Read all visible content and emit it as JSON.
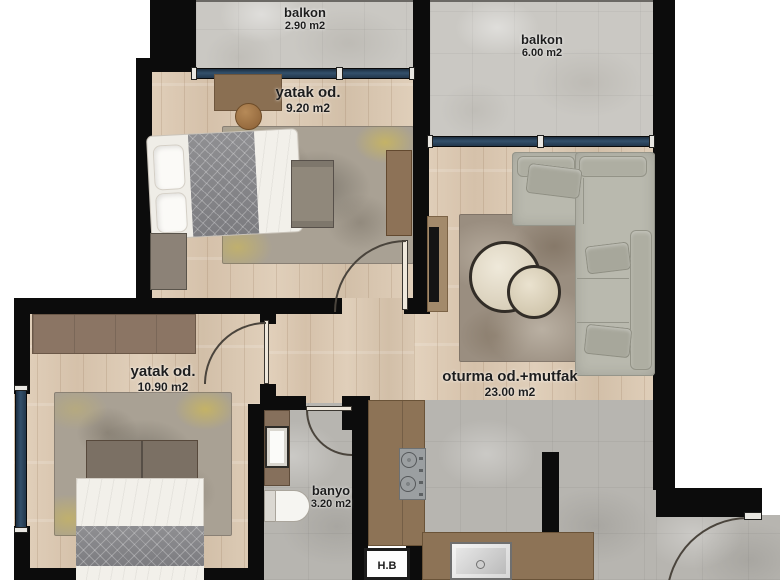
{
  "title": "apartment floor plan",
  "rooms": {
    "balkon1": {
      "name": "balkon",
      "area": "2.90 m2"
    },
    "balkon2": {
      "name": "balkon",
      "area": "6.00 m2"
    },
    "bedroom1": {
      "name": "yatak od.",
      "area": "9.20 m2"
    },
    "bedroom2": {
      "name": "yatak od.",
      "area": "10.90 m2"
    },
    "living": {
      "name": "oturma od.+mutfak",
      "area": "23.00 m2"
    },
    "bathroom": {
      "name": "banyo",
      "area": "3.20 m2"
    },
    "utility": {
      "name": "H.B",
      "area": ""
    }
  },
  "colors": {
    "wall": "#0c0c0c",
    "wood_floor": "#ddcbb6",
    "balcony_tile": "#cac8c3",
    "wet_tile": "#b7b5b0",
    "window_glass": "#2b4761",
    "counter_brown": "#8d7356",
    "sofa_gray": "#b9b9ae",
    "rug_accent_yellow": "#d6be48",
    "label_text": "#1d1d1d"
  }
}
